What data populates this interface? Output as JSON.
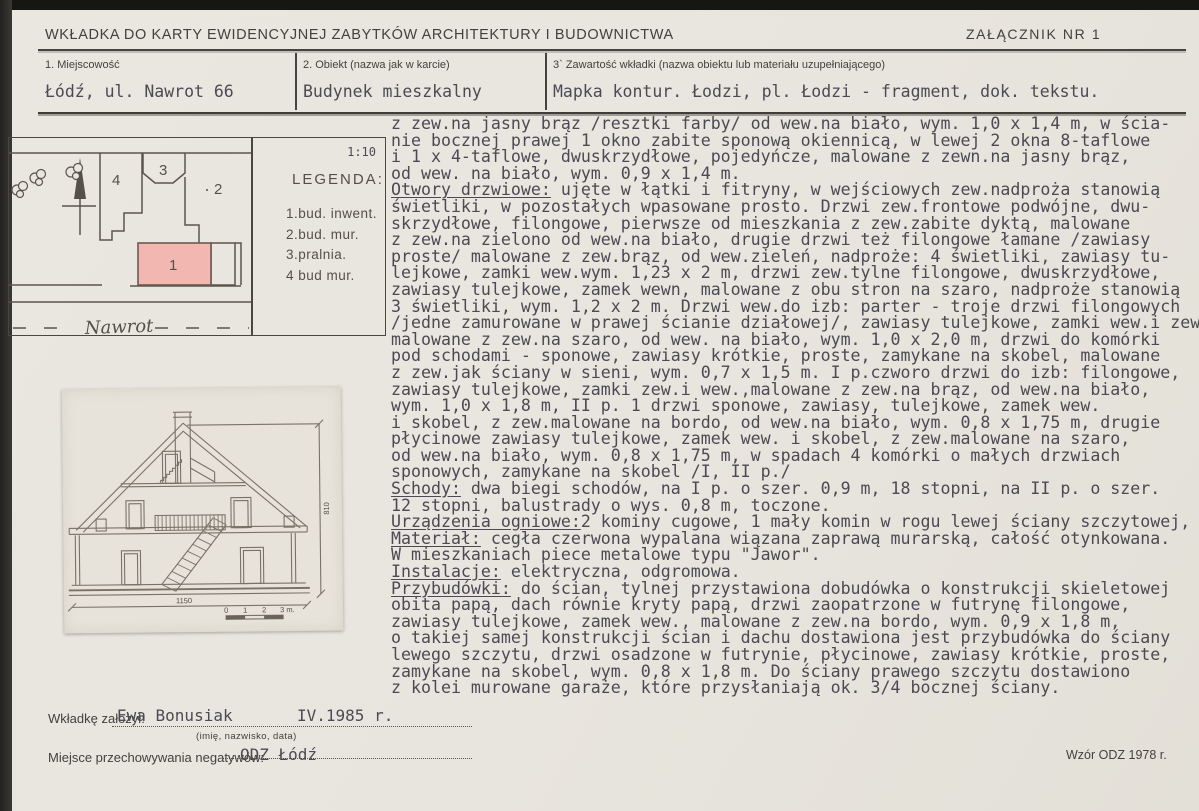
{
  "header": {
    "title": "WKŁADKA DO KARTY EWIDENCYJNEJ ZABYTKÓW ARCHITEKTURY I BUDOWNICTWA",
    "attachment": "ZAŁĄCZNIK NR 1"
  },
  "fields": [
    {
      "label": "1. Miejscowość",
      "value": "Łódź, ul. Nawrot 66"
    },
    {
      "label": "2. Obiekt (nazwa jak w karcie)",
      "value": "Budynek mieszkalny"
    },
    {
      "label": "3` Zawartość wkładki (nazwa obiektu lub materiału uzupełniającego)",
      "value": "Mapka kontur. Łodzi, pl. Łodzi - fragment, dok. tekstu."
    }
  ],
  "map": {
    "scale": "1:10",
    "street": "Nawrot",
    "building_labels": [
      "1",
      "2",
      "3",
      "4"
    ],
    "highlight_color": "#f2b7b1"
  },
  "legend": {
    "title": "LEGENDA:",
    "items": [
      "1.bud. inwent.",
      "2.bud. mur.",
      "3.pralnia.",
      "4 bud mur."
    ]
  },
  "drawing": {
    "height_dim": "810",
    "width_dim": "1150",
    "scalebar_labels": [
      "0",
      "1",
      "2",
      "3 m."
    ]
  },
  "text": {
    "lines": [
      {
        "t": "z zew.na jasny brąz /resztki farby/ od wew.na biało, wym. 1,0 x 1,4 m, w ścia-"
      },
      {
        "t": "nie bocznej prawej 1 okno zabite sponową okiennicą, w lewej 2 okna 8-taflowe"
      },
      {
        "t": "i 1 x 4-taflowe, dwuskrzydłowe, pojedyńcze, malowane z zewn.na jasny brąz,"
      },
      {
        "t": "od wew. na biało, wym. 0,9 x 1,4 m."
      },
      {
        "u": "Otwory drzwiowe:",
        "t": " ujęte w łątki i fitryny, w wejściowych zew.nadproża stanowią"
      },
      {
        "t": "świetliki, w pozostałych wpasowane prosto. Drzwi zew.frontowe podwójne, dwu-"
      },
      {
        "t": "skrzydłowe, filongowe, pierwsze od mieszkania z zew.zabite dyktą, malowane"
      },
      {
        "t": "z zew.na zielono od wew.na biało, drugie drzwi też filongowe łamane /zawiasy"
      },
      {
        "t": "proste/ malowane z zew.brąz, od wew.zieleń, nadproże: 4 świetliki, zawiasy tu-"
      },
      {
        "t": "lejkowe, zamki wew.wym. 1,23 x 2 m, drzwi zew.tylne filongowe, dwuskrzydłowe,"
      },
      {
        "t": "zawiasy tulejkowe, zamek wewn, malowane z obu stron na szaro, nadproże stanowią"
      },
      {
        "t": "3 świetliki, wym. 1,2 x 2 m. Drzwi wew.do izb: parter - troje drzwi filongowych"
      },
      {
        "t": "/jedne zamurowane w prawej ścianie działowej/, zawiasy tulejkowe, zamki wew.i zew"
      },
      {
        "t": "malowane z zew.na szaro, od wew. na biało, wym. 1,0 x 2,0 m, drzwi do komórki"
      },
      {
        "t": "pod schodami - sponowe, zawiasy krótkie, proste, zamykane na skobel, malowane"
      },
      {
        "t": "z zew.jak ściany w sieni, wym. 0,7 x 1,5 m. I p.czworo drzwi do izb: filongowe,"
      },
      {
        "t": "zawiasy tulejkowe, zamki zew.i wew.,malowane z zew.na brąz, od wew.na biało,"
      },
      {
        "t": "wym. 1,0 x 1,8 m, II p. 1 drzwi sponowe, zawiasy, tulejkowe, zamek wew."
      },
      {
        "t": "i skobel, z zew.malowane na bordo, od wew.na biało, wym. 0,8 x 1,75 m, drugie"
      },
      {
        "t": "płycinowe zawiasy tulejkowe, zamek wew. i skobel, z zew.malowane na szaro,"
      },
      {
        "t": "od wew.na biało, wym. 0,8 x 1,75 m, w spadach 4 komórki o małych drzwiach"
      },
      {
        "t": "sponowych, zamykane na skobel /I, II p./"
      },
      {
        "u": "Schody:",
        "t": " dwa biegi schodów, na I p. o szer. 0,9 m, 18 stopni, na II p. o szer."
      },
      {
        "t": "12 stopni, balustrady o wys. 0,8 m, toczone."
      },
      {
        "u": "Urządzenia ogniowe:",
        "t": "2 kominy cugowe, 1 mały komin w rogu lewej ściany szczytowej,"
      },
      {
        "u": "Materiał:",
        "t": " cegła czerwona wypalana wiązana zaprawą murarską, całość otynkowana."
      },
      {
        "t": "W mieszkaniach piece metalowe typu \"Jawor\"."
      },
      {
        "u": "Instalacje:",
        "t": " elektryczna, odgromowa."
      },
      {
        "u": "Przybudówki:",
        "t": " do ścian, tylnej przystawiona dobudówka o konstrukcji skieletowej"
      },
      {
        "t": "obita papą, dach równie kryty papą, drzwi zaopatrzone w futrynę filongowe,"
      },
      {
        "t": "zawiasy tulejkowe, zamek wew., malowane z zew.na bordo, wym. 0,9 x 1,8 m,"
      },
      {
        "t": "o takiej samej konstrukcji ścian i dachu dostawiona jest przybudówka do ściany"
      },
      {
        "t": "lewego szczytu, drzwi osadzone w futrynie, płycinowe, zawiasy krótkie, proste,"
      },
      {
        "t": "zamykane na skobel, wym. 0,8 x 1,8 m. Do ściany prawego szczytu dostawiono"
      },
      {
        "t": "z kolei murowane garaże, które przysłaniają ok. 3/4 bocznej ściany."
      }
    ]
  },
  "footer": {
    "founder_label": "Wkładkę założył:",
    "founder_name": "Ewa Bonusiak",
    "founder_date": "IV.1985 r.",
    "founder_note": "(imię, nazwisko, data)",
    "negatives_label": "Miejsce przechowywania negatywów:",
    "negatives_value": "ODZ Łódź",
    "pattern_note": "Wzór ODZ 1978 r."
  },
  "colors": {
    "paper": "#e8e5de",
    "typed_ink": "#4c4a54",
    "print_ink": "#43413b",
    "rule": "#45433d",
    "map_line": "#5b554d",
    "highlight_pink": "#f2b7b1",
    "drawing_line": "#7b7267"
  }
}
